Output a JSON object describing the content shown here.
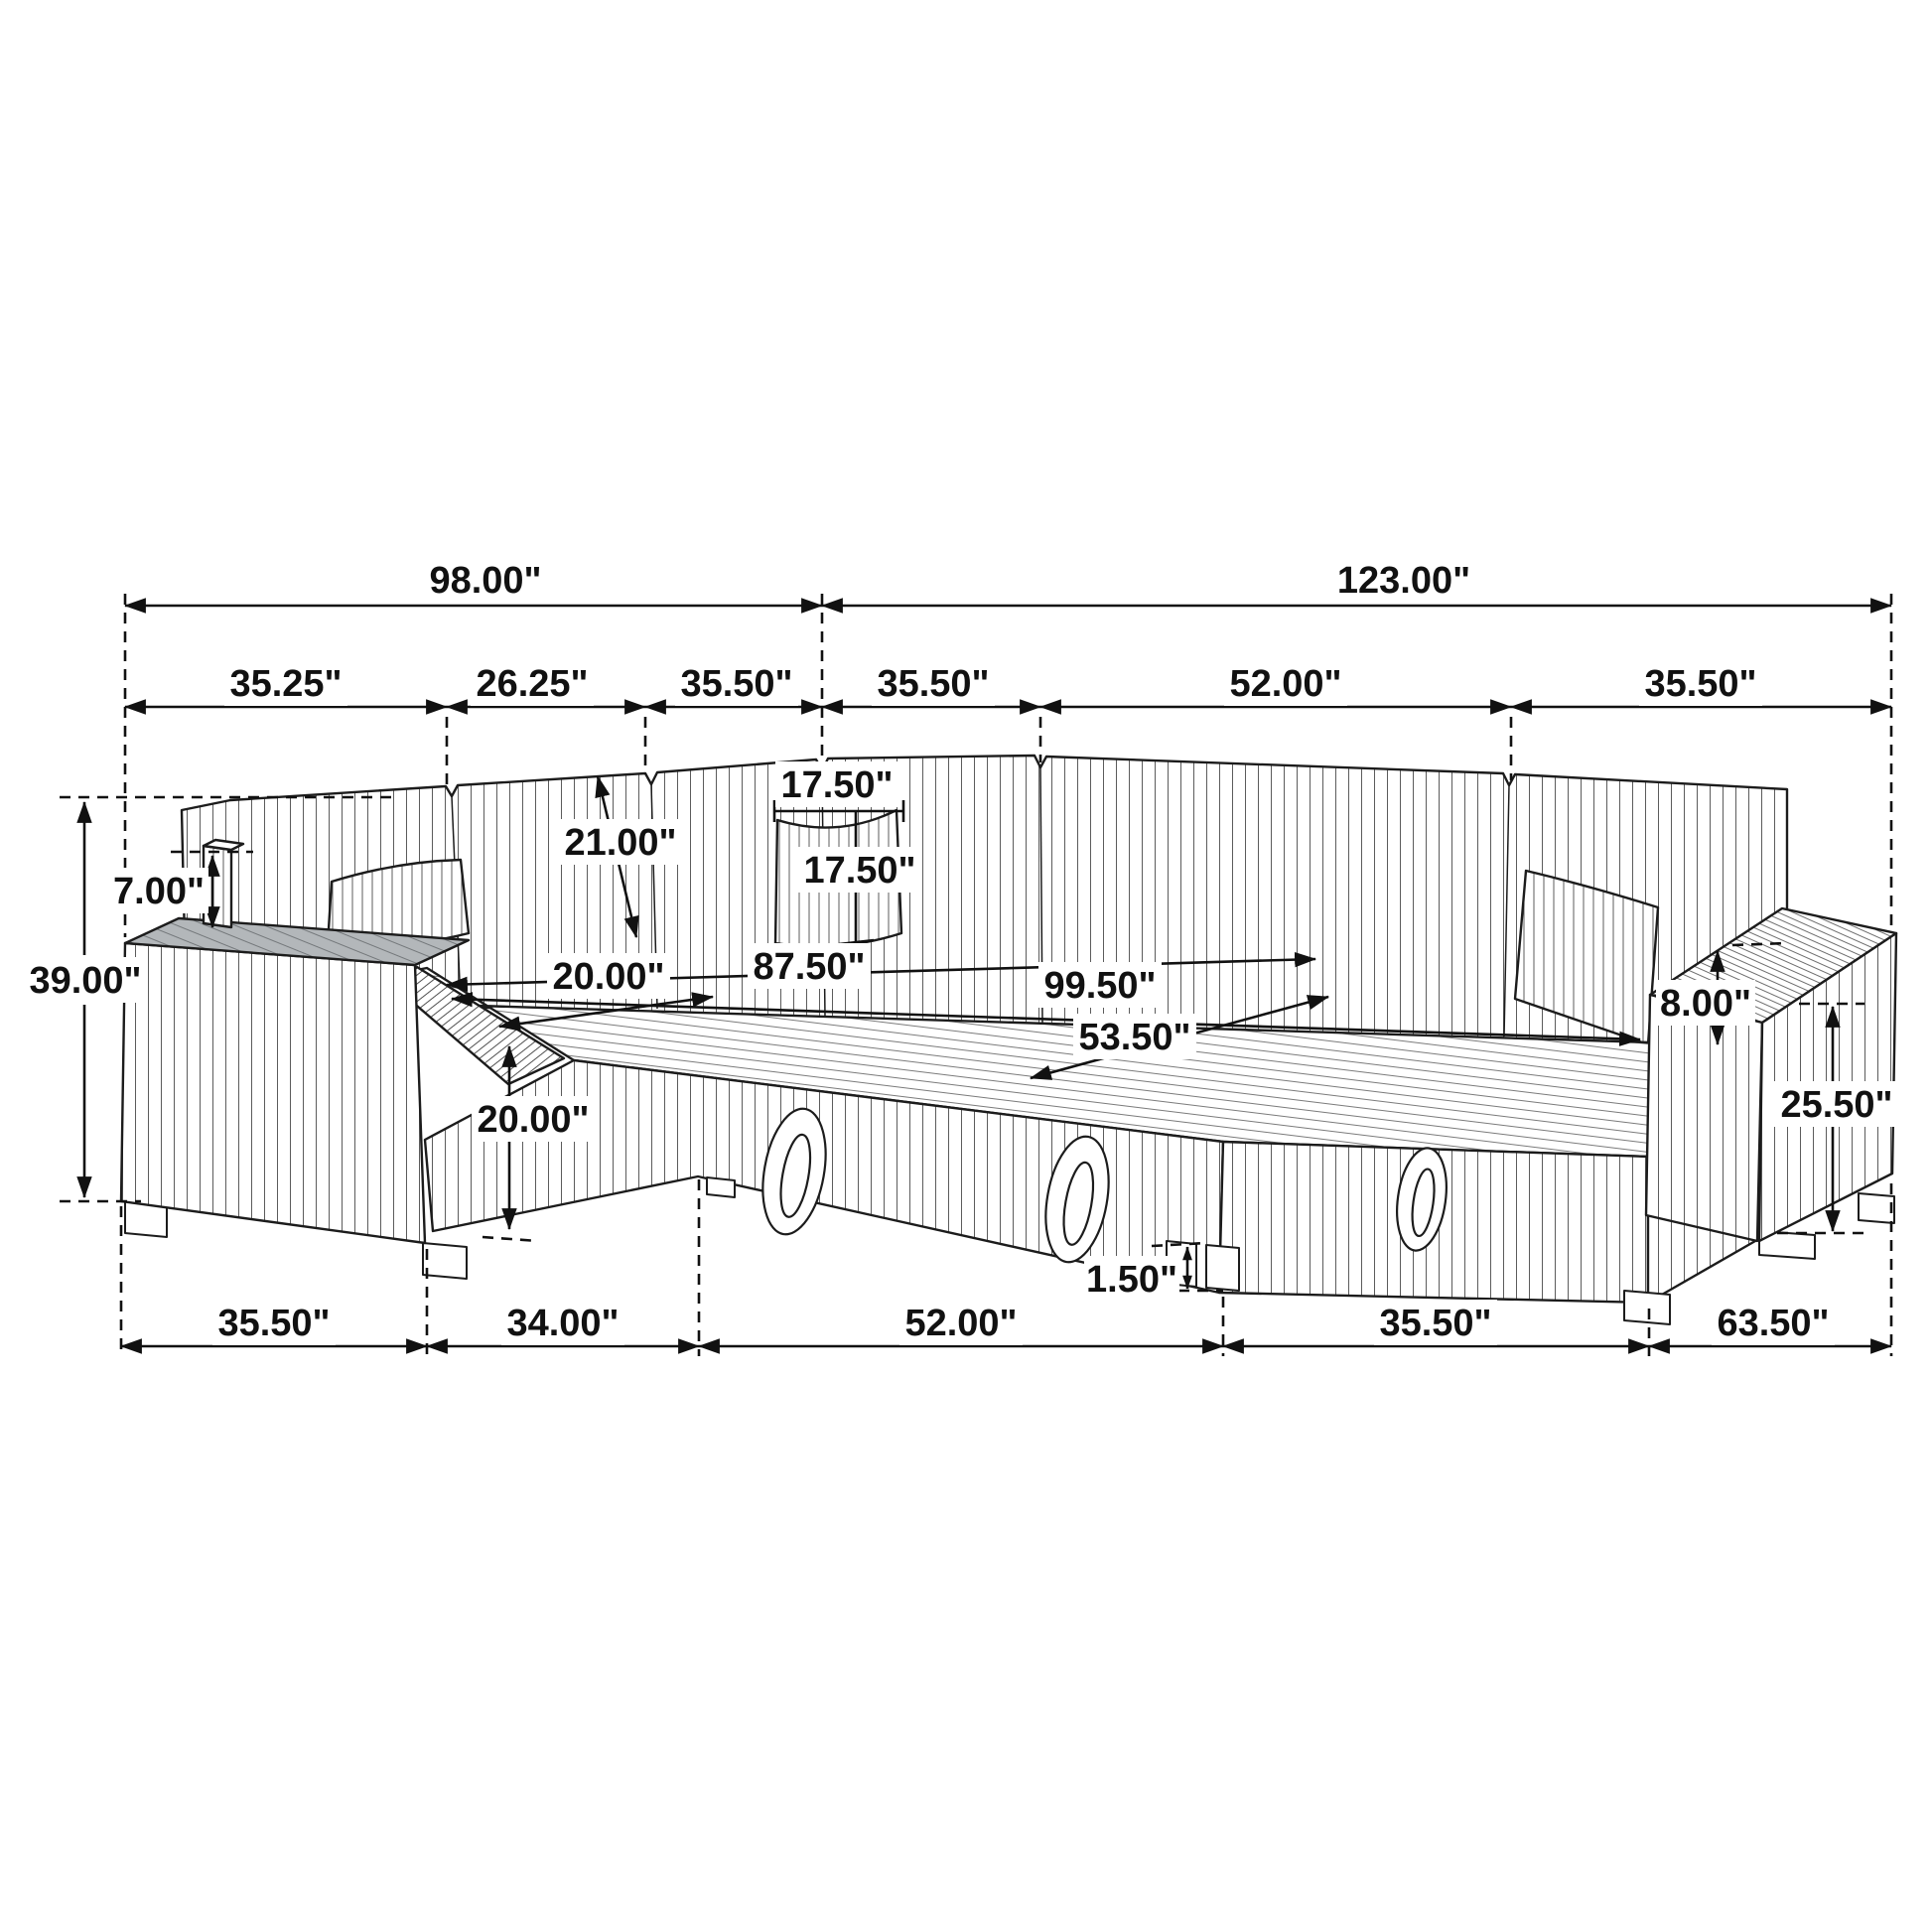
{
  "diagram": {
    "type": "furniture-dimension-drawing",
    "subject": "U-shaped sectional sleeper sofa with storage chaise and pull-out bed",
    "unit": "inches",
    "colors": {
      "line": "#1c1c1c",
      "tray_shade": "#b3b7ba",
      "background": "#ffffff"
    }
  },
  "dimensions": {
    "overall_back_left": "98.00\"",
    "overall_back_right": "123.00\"",
    "top_seg_1": "35.25\"",
    "top_seg_2": "26.25\"",
    "top_seg_3": "35.50\"",
    "top_seg_4": "35.50\"",
    "top_seg_5": "52.00\"",
    "top_seg_6": "35.50\"",
    "total_height": "39.00\"",
    "arm_shelf_height": "7.00\"",
    "backrest_height": "21.00\"",
    "pillow_width": "17.50\"",
    "pillow_height": "17.50\"",
    "seat_depth": "20.00\"",
    "seat_height": "20.00\"",
    "bed_length_inner": "87.50\"",
    "bed_length_outer": "99.50\"",
    "bed_width": "53.50\"",
    "arm_above_seat": "8.00\"",
    "arm_height": "25.50\"",
    "leg_height": "1.50\"",
    "bottom_seg_1": "35.50\"",
    "bottom_seg_2": "34.00\"",
    "bottom_seg_3": "52.00\"",
    "bottom_seg_4": "35.50\"",
    "bottom_seg_5": "63.50\""
  }
}
